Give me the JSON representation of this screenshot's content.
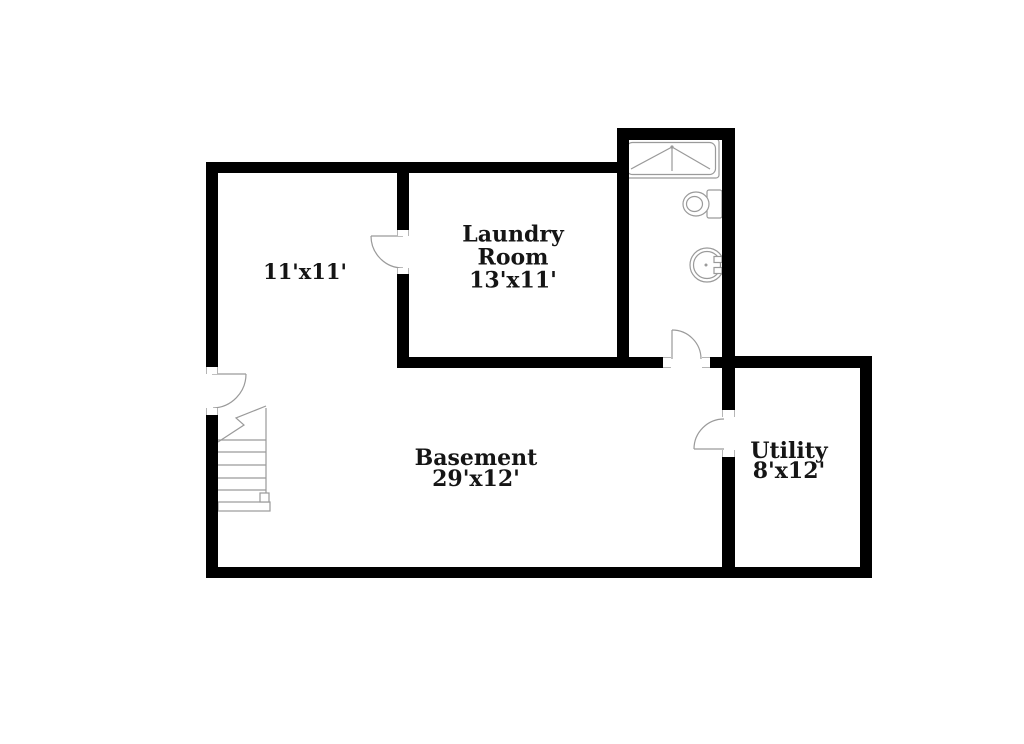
{
  "plan": {
    "title": "Basement floor plan",
    "background_color": "#ffffff",
    "wall_color": "#000000",
    "fixture_line_color": "#9a9a9a",
    "text_color": "#151515",
    "rooms": [
      {
        "name": "room-11x11",
        "lines": [
          "11'x11'"
        ]
      },
      {
        "name": "laundry-room",
        "lines": [
          "Laundry",
          "Room",
          "13'x11'"
        ]
      },
      {
        "name": "basement",
        "lines": [
          "Basement",
          "29'x12'"
        ]
      },
      {
        "name": "utility",
        "lines": [
          "Utility",
          "8'x12'"
        ]
      }
    ],
    "fixtures": [
      "shower",
      "toilet",
      "sink",
      "staircase"
    ],
    "doors": [
      "stair-door",
      "room-door",
      "bathroom-door",
      "utility-door"
    ]
  }
}
